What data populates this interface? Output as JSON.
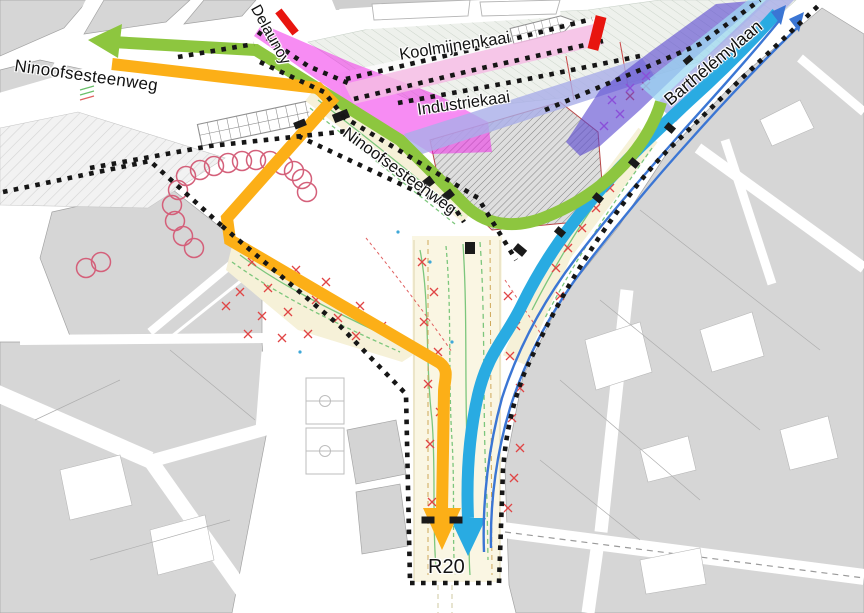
{
  "map": {
    "street_labels": [
      {
        "id": "ninoofsesteenweg-west",
        "text": "Ninoofsesteenweg"
      },
      {
        "id": "delaunoy",
        "text": "Delaunoy"
      },
      {
        "id": "koolmijnenkaai",
        "text": "Koolmijnenkaai"
      },
      {
        "id": "industriekaai",
        "text": "Industriekaai"
      },
      {
        "id": "ninoofsesteenweg-center",
        "text": "Ninoofsesteenweg"
      },
      {
        "id": "barthelemylaan",
        "text": "Barthélémylaan"
      },
      {
        "id": "r20",
        "text": "R20"
      }
    ],
    "routes": [
      {
        "name": "green-route",
        "color": "#8dc63f",
        "arrow_end": "west"
      },
      {
        "name": "yellow-route",
        "color": "#fcaf17",
        "arrow_end": "south"
      },
      {
        "name": "blue-route-thick",
        "color": "#29abe2",
        "arrow_end": "south"
      },
      {
        "name": "blue-route-thin",
        "color": "#3b76d4",
        "arrow_end": "north-east",
        "arrow_count": 2
      }
    ],
    "zones": [
      {
        "name": "koolmijnenkaai-magenta-zone",
        "color": "#f01ae8"
      },
      {
        "name": "koolmijnenkaai-pink-band",
        "color": "#f4bce4"
      },
      {
        "name": "industriekaai-band",
        "color": "#a9aee8"
      },
      {
        "name": "barthelemylaan-band",
        "color": "#a9aee8"
      },
      {
        "name": "barthelemylaan-lightcyan-band",
        "color": "#9ed8f2"
      },
      {
        "name": "purple-zone",
        "color": "#5a48d0"
      }
    ],
    "markers": [
      {
        "name": "closure-bar-delaunoy",
        "color": "#e8150f"
      },
      {
        "name": "closure-bar-koolmijnenkaai",
        "color": "#e8150f"
      }
    ]
  }
}
